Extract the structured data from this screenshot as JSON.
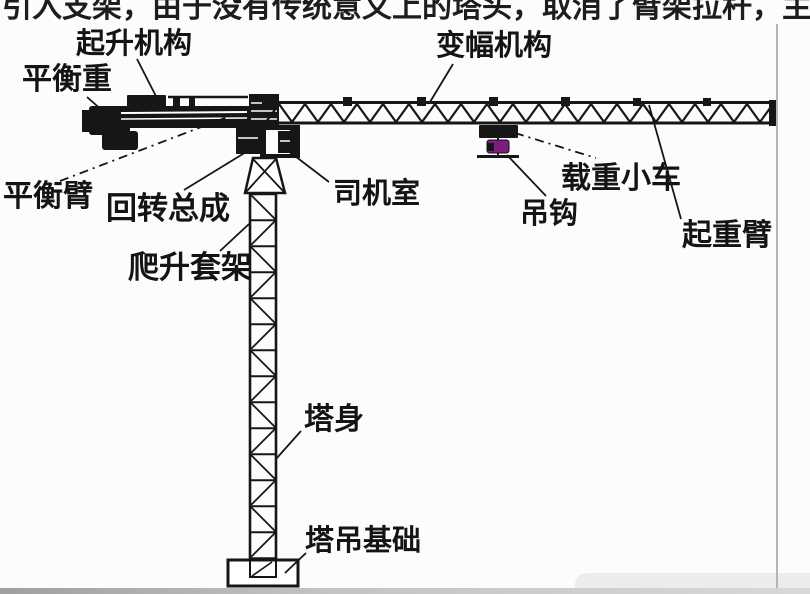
{
  "page": {
    "background": "#fcfcfc",
    "top_clipped_text": "引入支架，由于没有传统意义上的塔头，取消了臂架拉杆，主",
    "divider_color": "#b5b5b5"
  },
  "diagram": {
    "subject": "塔式起重机结构",
    "ink_color": "#161616",
    "hook_color": "#7b1f7d",
    "labels": [
      {
        "id": "hoisting-mechanism",
        "text": "起升机构"
      },
      {
        "id": "luffing-mechanism",
        "text": "变幅机构"
      },
      {
        "id": "counterweight",
        "text": "平衡重"
      },
      {
        "id": "counter-jib",
        "text": "平衡臂"
      },
      {
        "id": "slewing-assembly",
        "text": "回转总成"
      },
      {
        "id": "operator-cab",
        "text": "司机室"
      },
      {
        "id": "load-trolley",
        "text": "载重小车"
      },
      {
        "id": "hook",
        "text": "吊钩"
      },
      {
        "id": "lifting-jib",
        "text": "起重臂"
      },
      {
        "id": "climbing-frame",
        "text": "爬升套架"
      },
      {
        "id": "tower-body",
        "text": "塔身"
      },
      {
        "id": "tower-foundation",
        "text": "塔吊基础"
      }
    ]
  }
}
